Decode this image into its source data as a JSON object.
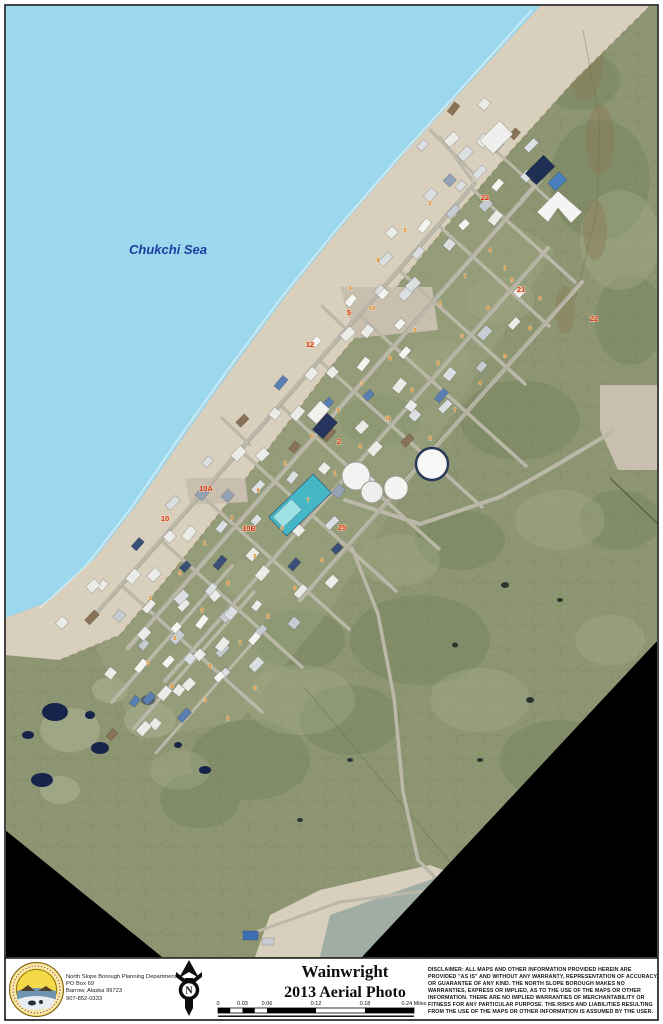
{
  "map": {
    "sea_label": "Chukchi Sea",
    "block_labels": [
      {
        "t": "10A",
        "x": 206,
        "y": 491
      },
      {
        "t": "10B",
        "x": 249,
        "y": 531
      },
      {
        "t": "10",
        "x": 165,
        "y": 521
      },
      {
        "t": "2",
        "x": 339,
        "y": 444
      },
      {
        "t": "22",
        "x": 594,
        "y": 321
      },
      {
        "t": "22",
        "x": 485,
        "y": 200
      },
      {
        "t": "5",
        "x": 349,
        "y": 315
      },
      {
        "t": "12",
        "x": 310,
        "y": 347
      },
      {
        "t": "25",
        "x": 342,
        "y": 530
      },
      {
        "t": "21",
        "x": 521,
        "y": 292
      }
    ],
    "lot_numbers": [
      {
        "x": 150,
        "y": 600,
        "t": "3"
      },
      {
        "x": 180,
        "y": 575,
        "t": "5"
      },
      {
        "x": 205,
        "y": 545,
        "t": "1"
      },
      {
        "x": 232,
        "y": 520,
        "t": "7"
      },
      {
        "x": 258,
        "y": 492,
        "t": "4"
      },
      {
        "x": 285,
        "y": 465,
        "t": "2"
      },
      {
        "x": 312,
        "y": 438,
        "t": "6"
      },
      {
        "x": 338,
        "y": 412,
        "t": "9"
      },
      {
        "x": 362,
        "y": 385,
        "t": "3"
      },
      {
        "x": 390,
        "y": 360,
        "t": "8"
      },
      {
        "x": 415,
        "y": 332,
        "t": "5"
      },
      {
        "x": 440,
        "y": 305,
        "t": "2"
      },
      {
        "x": 465,
        "y": 278,
        "t": "7"
      },
      {
        "x": 490,
        "y": 252,
        "t": "4"
      },
      {
        "x": 175,
        "y": 640,
        "t": "6"
      },
      {
        "x": 202,
        "y": 612,
        "t": "2"
      },
      {
        "x": 228,
        "y": 585,
        "t": "8"
      },
      {
        "x": 255,
        "y": 558,
        "t": "5"
      },
      {
        "x": 282,
        "y": 530,
        "t": "3"
      },
      {
        "x": 308,
        "y": 502,
        "t": "7"
      },
      {
        "x": 335,
        "y": 475,
        "t": "1"
      },
      {
        "x": 360,
        "y": 448,
        "t": "4"
      },
      {
        "x": 388,
        "y": 420,
        "t": "11"
      },
      {
        "x": 412,
        "y": 392,
        "t": "6"
      },
      {
        "x": 438,
        "y": 365,
        "t": "9"
      },
      {
        "x": 462,
        "y": 338,
        "t": "3"
      },
      {
        "x": 488,
        "y": 310,
        "t": "8"
      },
      {
        "x": 512,
        "y": 282,
        "t": "5"
      },
      {
        "x": 210,
        "y": 668,
        "t": "4"
      },
      {
        "x": 240,
        "y": 645,
        "t": "7"
      },
      {
        "x": 268,
        "y": 618,
        "t": "2"
      },
      {
        "x": 295,
        "y": 590,
        "t": "9"
      },
      {
        "x": 322,
        "y": 562,
        "t": "6"
      },
      {
        "x": 205,
        "y": 702,
        "t": "3"
      },
      {
        "x": 172,
        "y": 688,
        "t": "8"
      },
      {
        "x": 148,
        "y": 665,
        "t": "5"
      },
      {
        "x": 228,
        "y": 720,
        "t": "1"
      },
      {
        "x": 255,
        "y": 690,
        "t": "6"
      },
      {
        "x": 430,
        "y": 440,
        "t": "2"
      },
      {
        "x": 455,
        "y": 412,
        "t": "7"
      },
      {
        "x": 480,
        "y": 385,
        "t": "4"
      },
      {
        "x": 505,
        "y": 358,
        "t": "9"
      },
      {
        "x": 530,
        "y": 330,
        "t": "6"
      },
      {
        "x": 350,
        "y": 290,
        "t": "3"
      },
      {
        "x": 378,
        "y": 262,
        "t": "8"
      },
      {
        "x": 405,
        "y": 232,
        "t": "5"
      },
      {
        "x": 430,
        "y": 205,
        "t": "2"
      },
      {
        "x": 372,
        "y": 310,
        "t": "14"
      },
      {
        "x": 540,
        "y": 300,
        "t": "4"
      },
      {
        "x": 505,
        "y": 270,
        "t": "1"
      }
    ]
  },
  "footer": {
    "agency": {
      "name": "North Slope Borough Planning Department",
      "address_line1": "PO Box 69",
      "address_line2": "Barrow, Alaska 99723",
      "phone": "907-852-0333"
    },
    "title_line1": "Wainwright",
    "title_line2": "2013 Aerial Photo",
    "scale_bar": {
      "ticks": [
        "0",
        "0.03",
        "0.06",
        "0.12",
        "0.18"
      ],
      "end_label": "0.24 Miles"
    },
    "disclaimer": "DISCLAIMER: ALL MAPS AND OTHER INFORMATION PROVIDED HEREIN ARE PROVIDED \"AS IS\" AND WITHOUT ANY WARRANTY, REPRESENTATION OF ACCURACY, OR GUARANTEE OF ANY KIND. THE NORTH SLOPE BOROUGH MAKES NO WARRANTIES, EXPRESS OR IMPLIED, AS TO THE USE OF THE MAPS OR OTHER INFORMATION. THERE ARE NO IMPLIED WARRANTIES OF MERCHANTABILITY OR FITNESS FOR ANY PARTICULAR PURPOSE. THE RISKS AND LIABILITIES RESULTING FROM THE USE OF THE MAPS OR OTHER INFORMATION IS ASSUMED BY THE USER."
  },
  "colors": {
    "sea": "#9bd8ee",
    "beach": "#d8cfbd",
    "tundra": "#8d9572",
    "street": "#bcb8a9",
    "lot_number": "#e07818",
    "block_label": "#d42b1e",
    "sea_label": "#1d3e9e",
    "mask": "#000000"
  }
}
